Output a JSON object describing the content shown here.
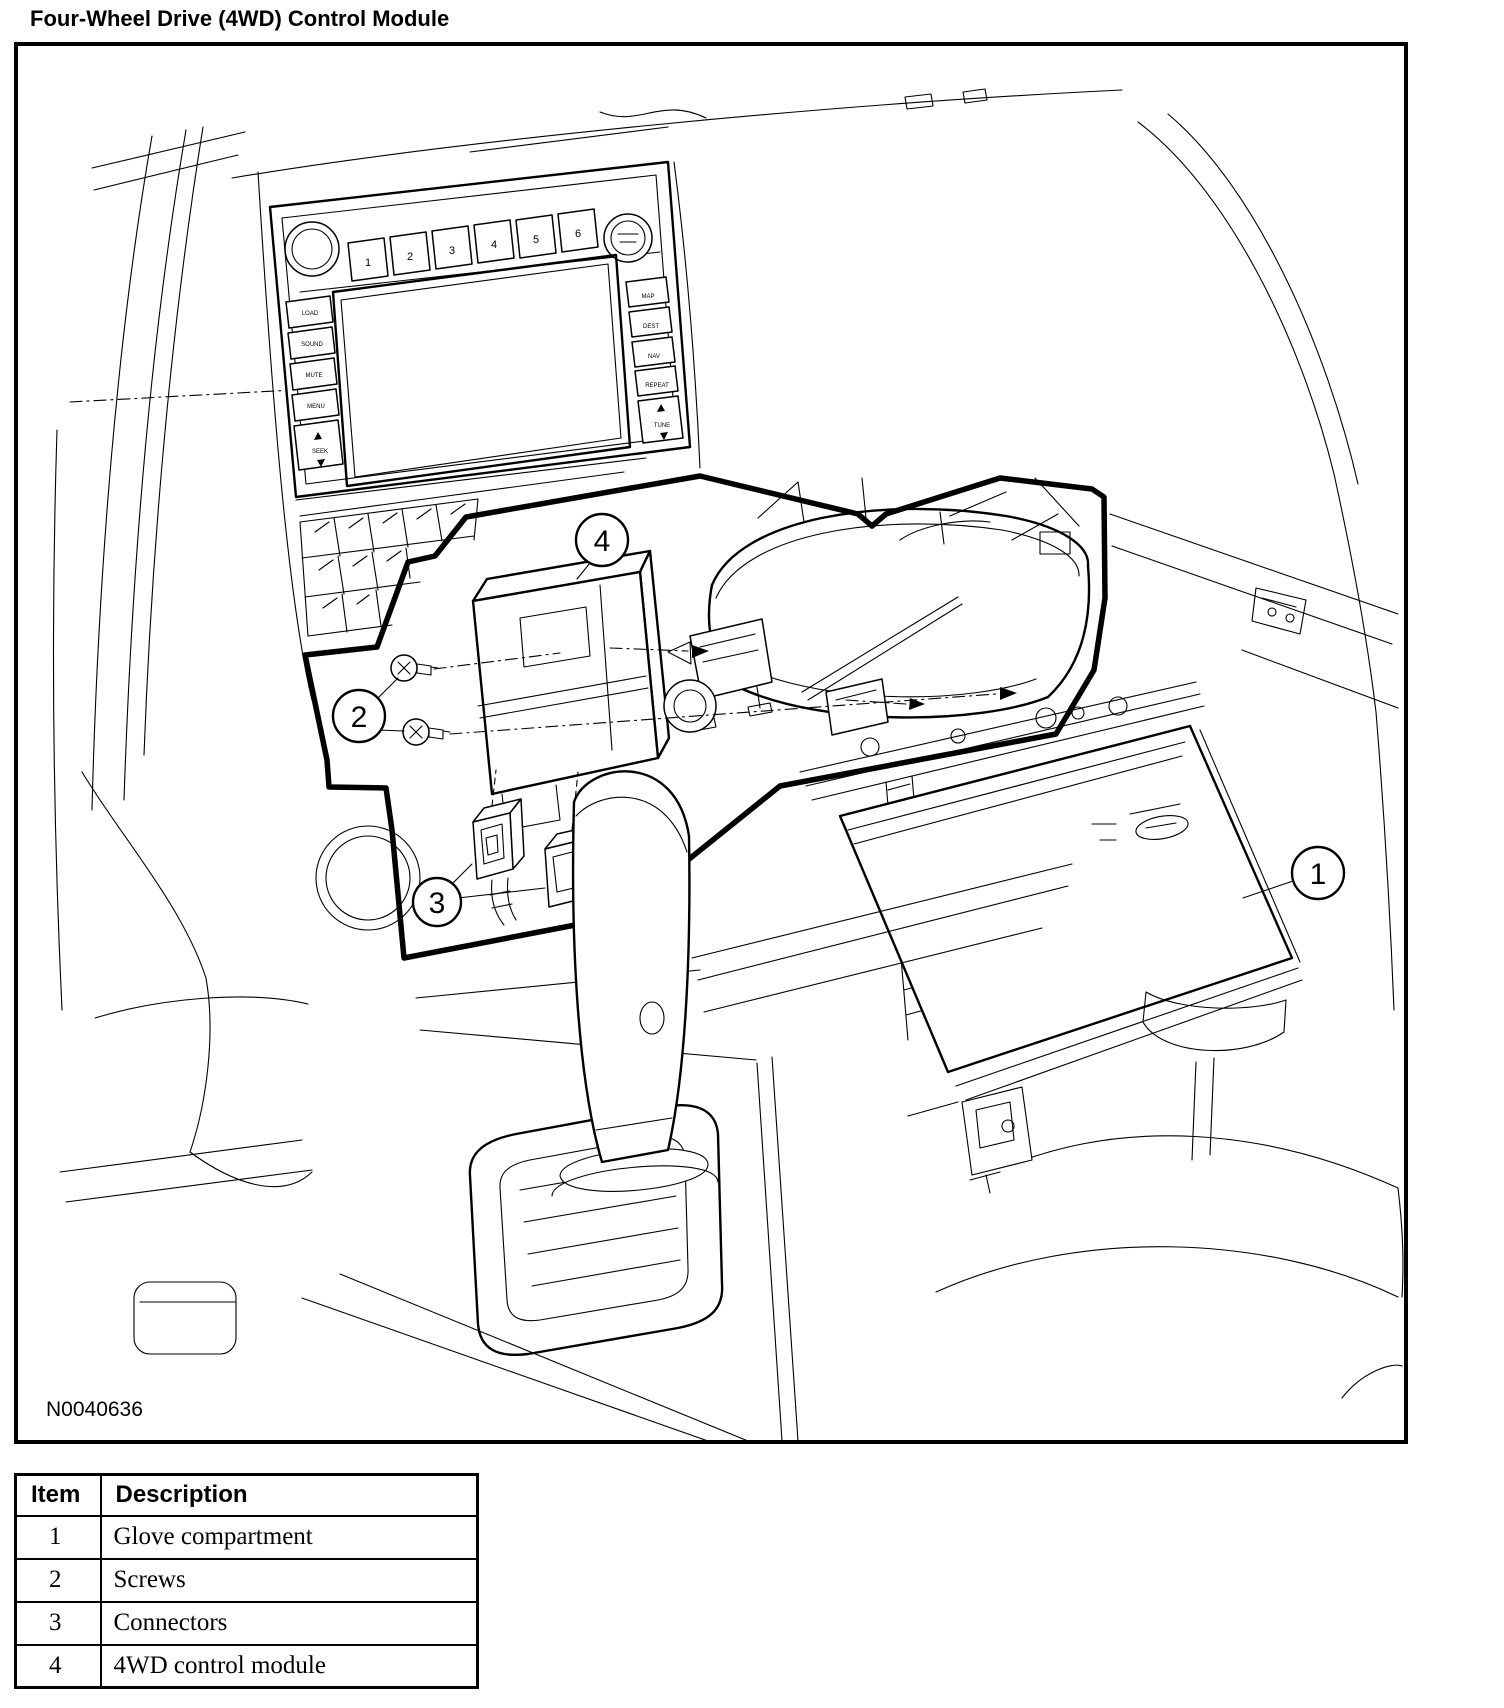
{
  "title": "Four-Wheel Drive (4WD) Control Module",
  "figure": {
    "id_label": "N0040636",
    "callouts": [
      "1",
      "2",
      "3",
      "4"
    ]
  },
  "radio": {
    "presets": [
      "1",
      "2",
      "3",
      "4",
      "5",
      "6"
    ],
    "left_buttons": [
      "LOAD",
      "SOUND",
      "MUTE",
      "MENU",
      "SEEK"
    ],
    "right_buttons": [
      "MAP",
      "DEST",
      "NAV",
      "REPEAT",
      "TUNE"
    ]
  },
  "table": {
    "headers": {
      "item": "Item",
      "description": "Description"
    },
    "rows": [
      {
        "item": "1",
        "description": "Glove compartment"
      },
      {
        "item": "2",
        "description": "Screws"
      },
      {
        "item": "3",
        "description": "Connectors"
      },
      {
        "item": "4",
        "description": "4WD control module"
      }
    ]
  }
}
